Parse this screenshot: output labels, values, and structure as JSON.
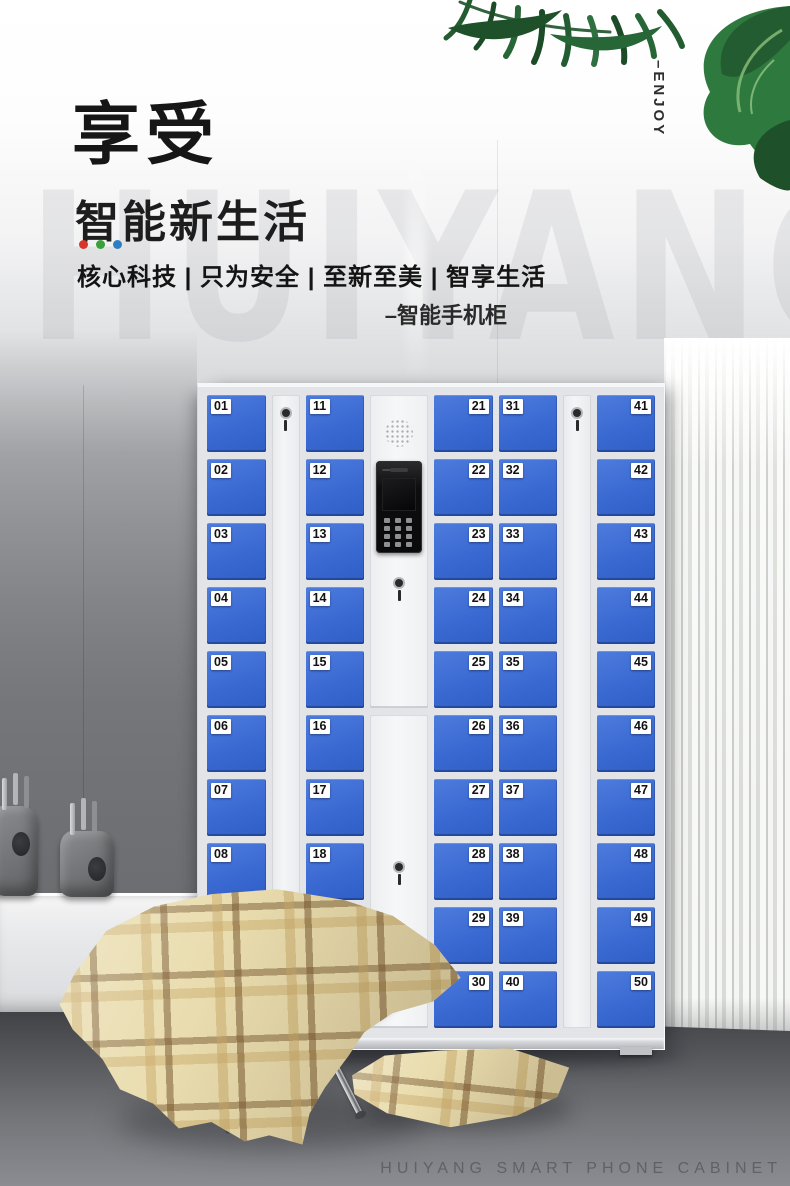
{
  "hero": {
    "title": "享受",
    "subtitle": "智能新生活",
    "accent_dots": [
      "#d7372a",
      "#39a13b",
      "#2d7fc3"
    ],
    "tagline": "核心科技 | 只为安全 | 至新至美 | 智享生活",
    "product_label": "–智能手机柜",
    "vertical_label": "–ENJOY",
    "watermark": "HUIYANG"
  },
  "footer": {
    "caption": "HUIYANG SMART PHONE CABINET"
  },
  "cabinet": {
    "colors": {
      "door_blue": "#3a69d2",
      "frame": "#eef0f3",
      "label_bg": "#ffffff",
      "label_text": "#111111"
    },
    "icons": [
      "speaker-grille-icon",
      "camera-icon",
      "keypad-icon",
      "key-lock-icon",
      "keyhole-icon"
    ],
    "columns": [
      {
        "type": "doors",
        "label_side": "left",
        "doors": [
          "01",
          "02",
          "03",
          "04",
          "05",
          "06",
          "07",
          "08",
          "09",
          "10"
        ]
      },
      {
        "type": "lock"
      },
      {
        "type": "doors",
        "label_side": "left",
        "doors": [
          "11",
          "12",
          "13",
          "14",
          "15",
          "16",
          "17",
          "18",
          "19",
          "20"
        ]
      },
      {
        "type": "panel"
      },
      {
        "type": "doors",
        "label_side": "right",
        "doors": [
          "21",
          "22",
          "23",
          "24",
          "25",
          "26",
          "27",
          "28",
          "29",
          "30"
        ]
      },
      {
        "type": "doors",
        "label_side": "left",
        "doors": [
          "31",
          "32",
          "33",
          "34",
          "35",
          "36",
          "37",
          "38",
          "39",
          "40"
        ]
      },
      {
        "type": "lock"
      },
      {
        "type": "doors",
        "label_side": "right",
        "doors": [
          "41",
          "42",
          "43",
          "44",
          "45",
          "46",
          "47",
          "48",
          "49",
          "50"
        ]
      }
    ]
  },
  "scene": {
    "colors": {
      "leaf_dark": "#1e5129",
      "leaf_mid": "#276636",
      "leaf_bright": "#2e7a3e",
      "leaf_vein": "#8cc07c",
      "curtain": "#f1f2f0",
      "floor_dark": "#3b3d41",
      "floor_light": "#8b8c91",
      "blanket_base": "#e9dcae",
      "blanket_stripe_dark": "#7a5a32",
      "blanket_stripe_mid": "#c9a968",
      "cushion_green": "#aabfab"
    }
  }
}
